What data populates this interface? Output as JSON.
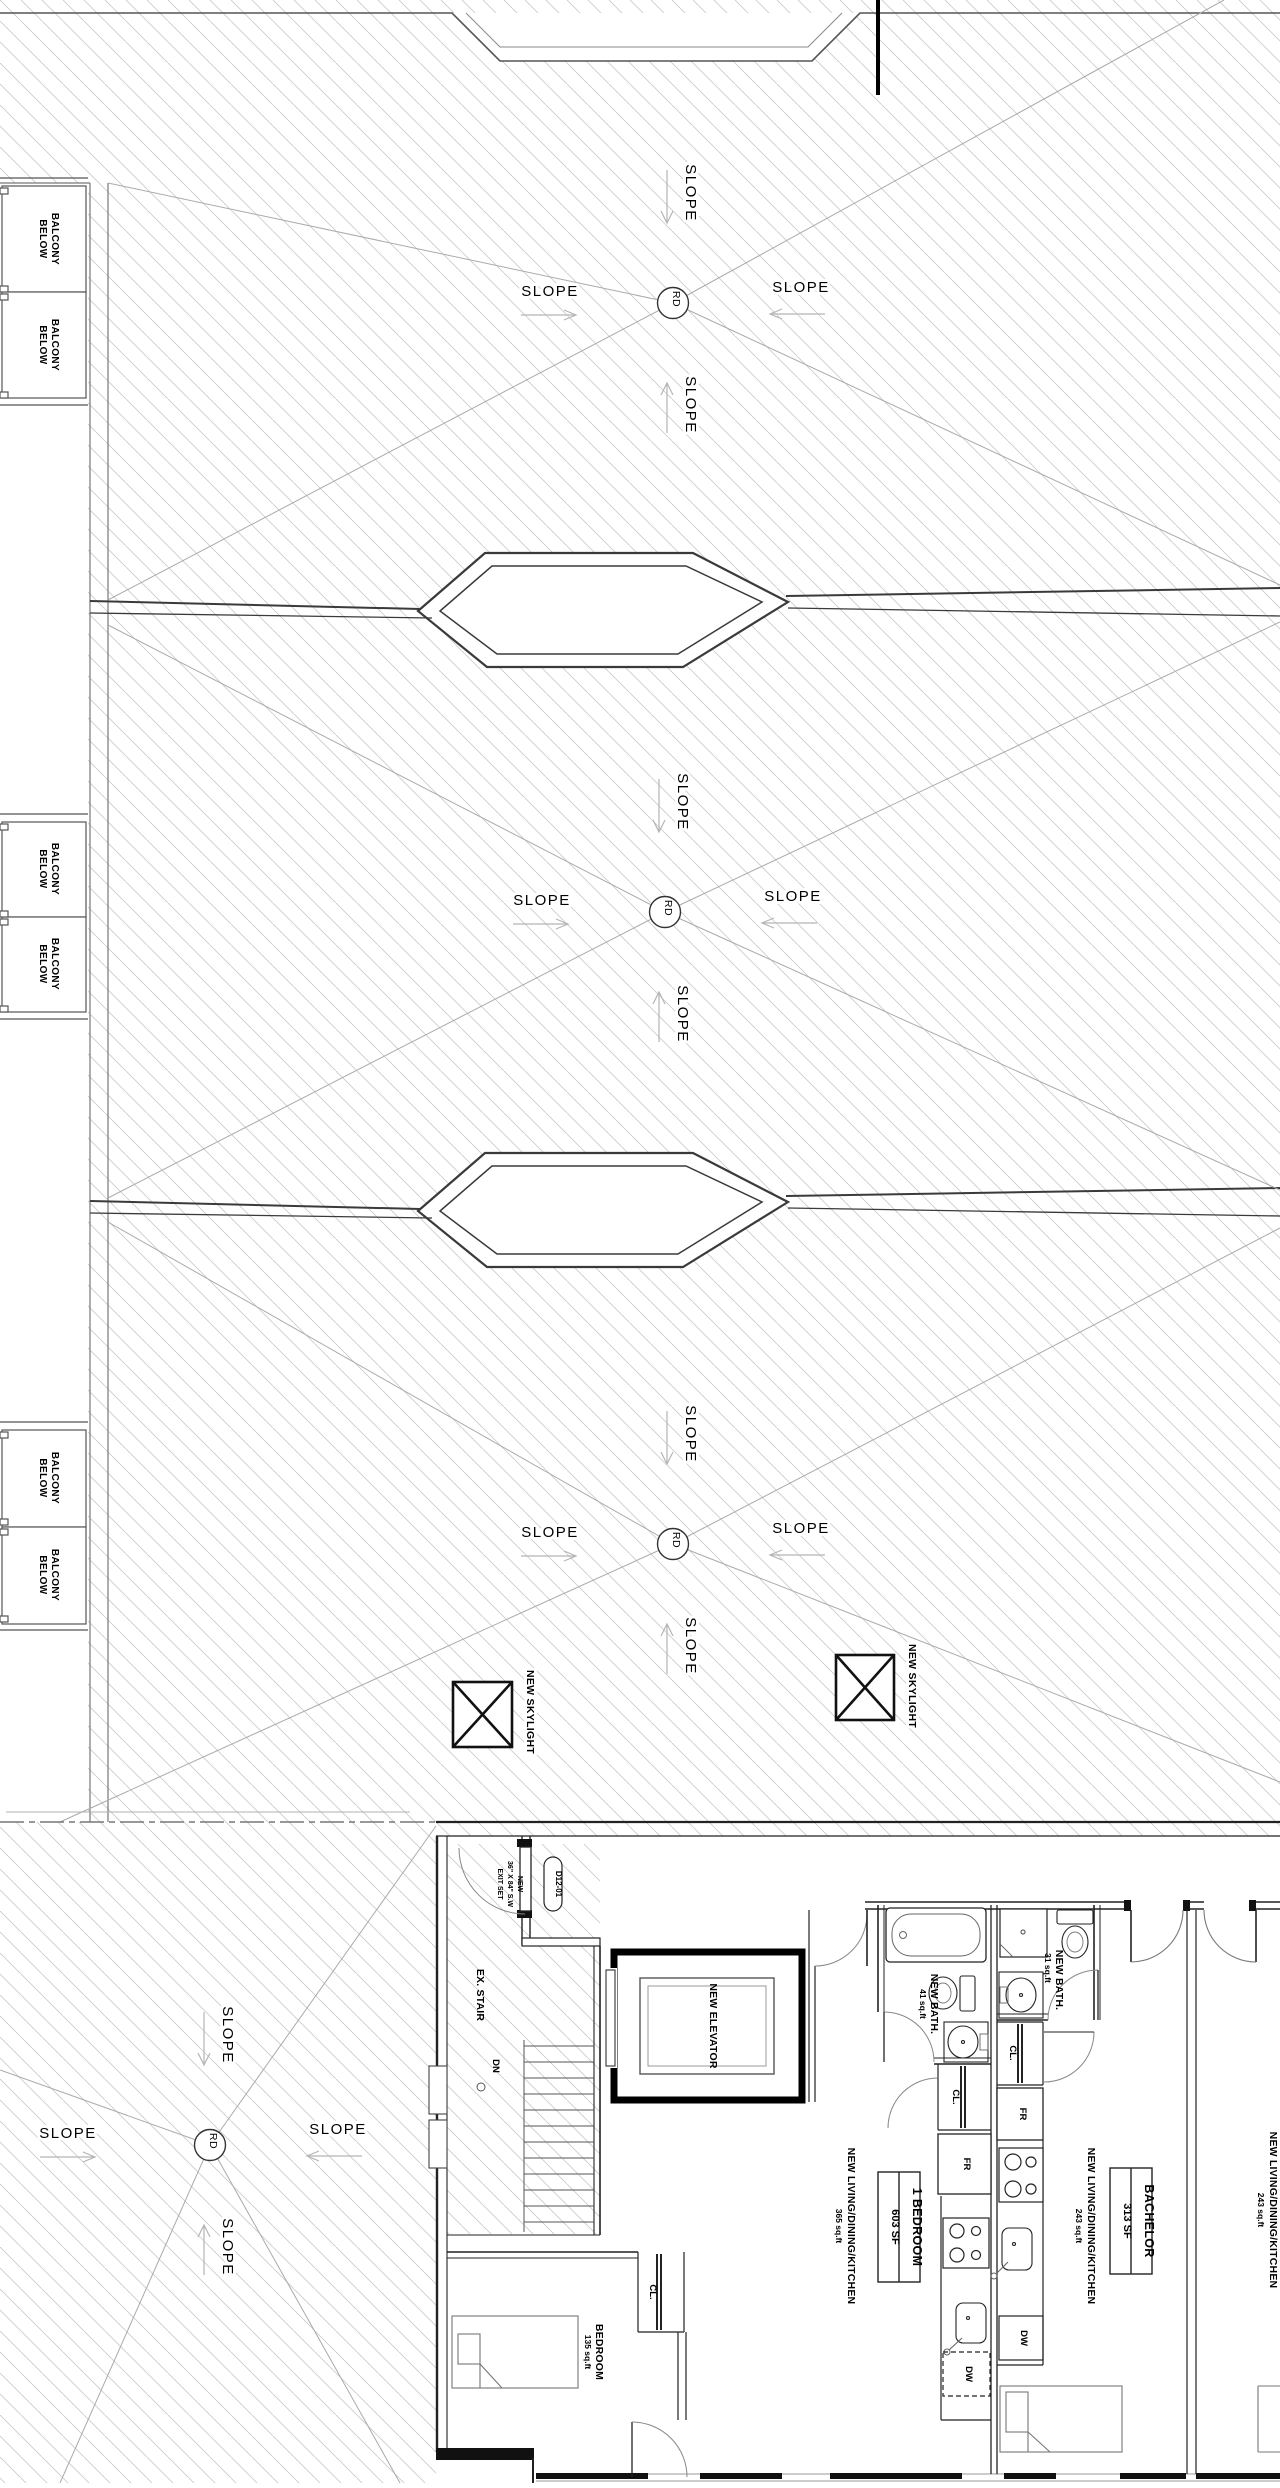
{
  "drawing_type": "architectural roof and floor plan",
  "colors": {
    "lines": "#222222",
    "hatch": "#cccccc",
    "background": "#ffffff"
  },
  "labels": {
    "slope": "SLOPE",
    "rd": "RD",
    "balcony_line1": "BALCONY",
    "balcony_line2": "BELOW",
    "new_skylight": "NEW SKYLIGHT",
    "ex_stair": "EX. STAIR",
    "down": "DN",
    "new_elevator": "NEW ELEVATOR",
    "door_tag": "D12-01",
    "door_spec_line1": "NEW",
    "door_spec_line2": "36\" X 84\" S.W",
    "door_spec_line3": "EXIT SET",
    "closet": "CL.",
    "fridge": "FR",
    "dishwasher": "DW",
    "bath1_name": "NEW BATH.",
    "bath1_area": "41 sq.ft",
    "bath2_name": "NEW BATH.",
    "bath2_area": "31 sq.ft",
    "living_kitchen": "NEW LIVING/DINING/KITCHEN",
    "living1_area": "365 sq.ft",
    "living2_area": "243 sq.ft",
    "living3_area": "243 sq.ft",
    "unit1_type": "1 BEDROOM",
    "unit1_area": "603 SF",
    "unit2_type": "BACHELOR",
    "unit2_area": "313 SF",
    "bedroom_name": "BEDROOM",
    "bedroom_area": "135 sq.ft"
  }
}
